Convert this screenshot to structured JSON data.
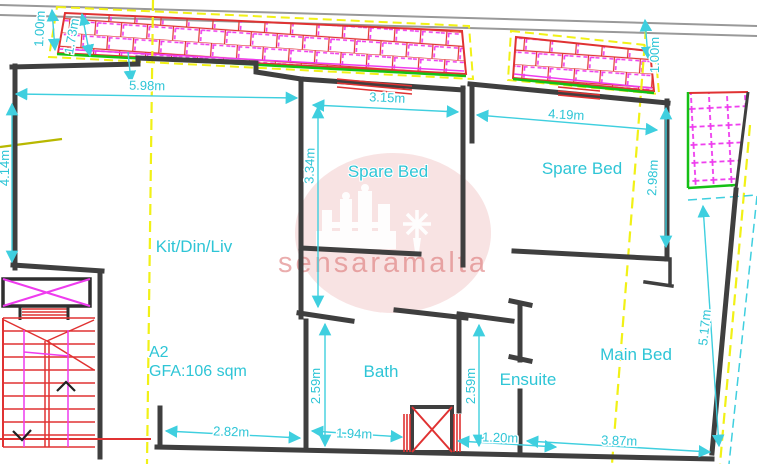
{
  "plan": {
    "unit_label": "A2",
    "gfa_label": "GFA:106 sqm",
    "rooms": {
      "kitchen_living": "Kit/Din/Liv",
      "spare_bed_1": "Spare Bed",
      "spare_bed_2": "Spare Bed",
      "bath": "Bath",
      "ensuite": "Ensuite",
      "main_bed": "Main Bed"
    },
    "dimensions": {
      "kit_width": "5.98m",
      "kit_height": "4.14m",
      "pavement_left": "1.00m",
      "balcony_left_depth": "1.73m",
      "spare1_width": "3.15m",
      "spare1_height": "3.34m",
      "spare2_width": "4.19m",
      "pavement_right": "1.00m",
      "spare2_height": "2.98m",
      "main_bed_height": "5.17m",
      "bath_height": "2.59m",
      "ensuite_height": "2.59m",
      "stair_width": "2.82m",
      "bath_width": "1.94m",
      "ensuite_width": "1.20m",
      "main_bed_width": "3.87m"
    },
    "watermark": "sensaramalta",
    "colors": {
      "dimension_cyan": "#2ec5d6",
      "wall_dark": "#3f3f3f",
      "boundary_yellow": "#f1f116",
      "balcony_green": "#15c015",
      "hatch_red": "#e03232",
      "hatch_magenta": "#ee3cee",
      "street_gray": "#999999",
      "watermark_pink": "#f2cccc",
      "watermark_text": "#dd7777"
    }
  }
}
